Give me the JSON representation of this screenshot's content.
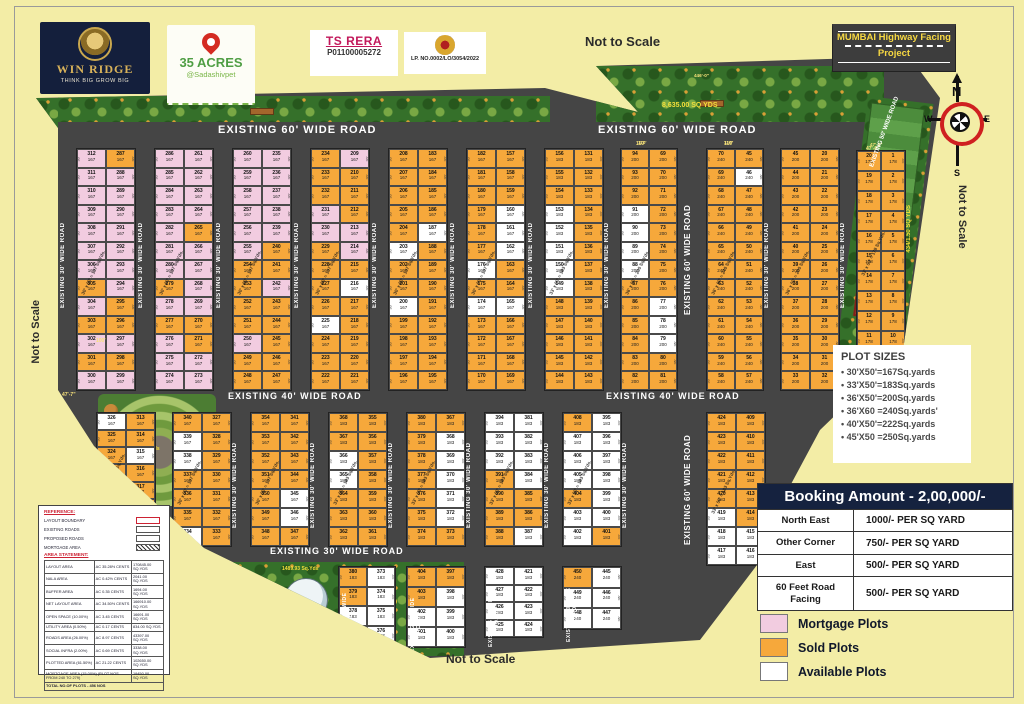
{
  "colors": {
    "bg": "#f3eda6",
    "road": "#454545",
    "mortgage": "#f2cce0",
    "sold": "#f6a83b",
    "available": "#ffffff",
    "navy": "#15223f"
  },
  "logos": {
    "winridge": {
      "title": "WIN RIDGE",
      "tagline": "THINK BIG GROW BIG"
    },
    "acres": {
      "title": "35 ACRES",
      "subtitle": "@Sadashivpet"
    },
    "rera": {
      "title": "TS RERA",
      "number": "P01100005272"
    },
    "dtcp": {
      "lp_no": "LP. NO.0002/LO/3054/2022"
    }
  },
  "mumbai_banner": {
    "line1": "MUMBAI Highway Facing",
    "line2": "Project"
  },
  "scale_notes": {
    "top": "Not to Scale",
    "right": "Not to Scale",
    "left": "Not to Scale",
    "bottom": "Not to Scale"
  },
  "compass": {
    "n": "N",
    "e": "E",
    "s": "S",
    "w": "W"
  },
  "plot_sizes": {
    "title": "PLOT SIZES",
    "items": [
      "30'X50'=167Sq.yards",
      "33'X50'=183Sq.yards",
      "36'X50'=200Sq.yards",
      "36'X60 =240Sq.yards'",
      "40'X50'=222Sq.yards",
      "45'X50 =250Sq.yards"
    ]
  },
  "booking": {
    "title": "Booking Amount - 2,00,000/-",
    "rows": [
      {
        "label": "North East",
        "value": "1000/- PER SQ YARD"
      },
      {
        "label": "Other Corner",
        "value": "750/- PER SQ YARD"
      },
      {
        "label": "East",
        "value": "500/- PER SQ YARD"
      },
      {
        "label": "60 Feet Road Facing",
        "value": "500/- PER SQ YARD"
      }
    ]
  },
  "legend": {
    "items": [
      {
        "label": "Mortgage Plots",
        "color": "#f2cce0"
      },
      {
        "label": "Sold Plots",
        "color": "#f6a83b"
      },
      {
        "label": "Available Plots",
        "color": "#ffffff"
      }
    ]
  },
  "reference": {
    "title": "REFERENCE:",
    "items": [
      "LAYOUT BOUNDARY",
      "EXISTING ROADS",
      "PROPOSED ROADS",
      "MORTGAGE AREA"
    ],
    "area_title": "AREA STATEMENT:",
    "rows": [
      [
        "LAYOUT AREA",
        "AC 35.28½ CENTS",
        "170845.00 SQ.YDS"
      ],
      [
        "NALA AREA",
        "AC 0.42½ CENTS",
        "2041.00 SQ.YDS"
      ],
      [
        "BUFFER AREA",
        "AC 0.35 CENTS",
        "1694.00 SQ.YDS"
      ],
      [
        "NET LAYOUT AREA",
        "AC 34.50½ CENTS",
        "166910.00 SQ.YDS"
      ],
      [
        "OPEN SPACE (10.00%)",
        "AC 3.45 CENTS",
        "16691.00 SQ.YDS"
      ],
      [
        "UTILITY AREA (0.50%)",
        "AC 0.17 CENTS",
        "834.00 SQ.YDS"
      ],
      [
        "ROADS AREA (26.00%)",
        "AC 8.97 CENTS",
        "43397.00 SQ.YDS"
      ],
      [
        "SOCIAL INFRA (2.00%)",
        "AC 0.69 CENTS",
        "3338.00 SQ.YDS"
      ],
      [
        "PLOTTED AREA (61.50%)",
        "AC 21.22 CENTS",
        "102650.00 SQ.YDS"
      ]
    ],
    "mortgage_row": [
      "MORTGAGE AREA (15.00%) (PLOT NOS FROM 240 TO 279)",
      "19450.00 SQ.YDS"
    ],
    "total": "TOTAL NO.OF PLOTS - 456 NOS"
  },
  "road_names": {
    "h60": "EXISTING   60'  WIDE ROAD",
    "h40": "EXISTING  40'  WIDE ROAD",
    "h30": "EXISTING  30'  WIDE ROAD",
    "v30": "EXISTING  30'  WIDE ROAD",
    "v60": "EXISTING  60'  WIDE ROAD",
    "v50": "EXISTING  50'  WIDE ROAD",
    "nala": "EXISTING 6.00 MTR NALA"
  },
  "hroad_labels": [
    {
      "x": 218,
      "y": 124,
      "t": "h60",
      "fs": 11
    },
    {
      "x": 598,
      "y": 124,
      "t": "h60",
      "fs": 11
    },
    {
      "x": 228,
      "y": 391,
      "t": "h40",
      "fs": 9
    },
    {
      "x": 606,
      "y": 391,
      "t": "h40",
      "fs": 9
    },
    {
      "x": 270,
      "y": 546,
      "t": "h30",
      "fs": 9
    }
  ],
  "vroad_labels": [
    {
      "x": 60,
      "y": 200,
      "h": 130,
      "t": "v30",
      "fs": 6
    },
    {
      "x": 138,
      "y": 200,
      "h": 130,
      "t": "v30",
      "fs": 6
    },
    {
      "x": 216,
      "y": 200,
      "h": 130,
      "t": "v30",
      "fs": 6
    },
    {
      "x": 294,
      "y": 200,
      "h": 130,
      "t": "v30",
      "fs": 6
    },
    {
      "x": 372,
      "y": 200,
      "h": 130,
      "t": "v30",
      "fs": 6
    },
    {
      "x": 450,
      "y": 200,
      "h": 130,
      "t": "v30",
      "fs": 6
    },
    {
      "x": 528,
      "y": 200,
      "h": 130,
      "t": "v30",
      "fs": 6
    },
    {
      "x": 604,
      "y": 200,
      "h": 130,
      "t": "v30",
      "fs": 6
    },
    {
      "x": 683,
      "y": 180,
      "h": 160,
      "t": "v60",
      "fs": 8
    },
    {
      "x": 683,
      "y": 420,
      "h": 140,
      "t": "v60",
      "fs": 8
    },
    {
      "x": 764,
      "y": 200,
      "h": 130,
      "t": "v30",
      "fs": 6
    },
    {
      "x": 840,
      "y": 200,
      "h": 130,
      "t": "v30",
      "fs": 6
    },
    {
      "x": 232,
      "y": 430,
      "h": 110,
      "t": "v30",
      "fs": 6
    },
    {
      "x": 310,
      "y": 430,
      "h": 110,
      "t": "v30",
      "fs": 6
    },
    {
      "x": 388,
      "y": 430,
      "h": 110,
      "t": "v30",
      "fs": 6
    },
    {
      "x": 466,
      "y": 430,
      "h": 110,
      "t": "v30",
      "fs": 6
    },
    {
      "x": 544,
      "y": 430,
      "h": 110,
      "t": "v30",
      "fs": 6
    },
    {
      "x": 622,
      "y": 430,
      "h": 110,
      "t": "v30",
      "fs": 6
    },
    {
      "x": 342,
      "y": 585,
      "h": 70,
      "t": "v30",
      "fs": 5
    },
    {
      "x": 410,
      "y": 590,
      "h": 70,
      "t": "v30",
      "fs": 5
    },
    {
      "x": 488,
      "y": 585,
      "h": 70,
      "t": "v30",
      "fs": 5
    },
    {
      "x": 566,
      "y": 580,
      "h": 70,
      "t": "v30",
      "fs": 5
    }
  ],
  "green_labels": {
    "top_garden": "8,635.00 SQ YDS",
    "right_park": "434/1.50 SQ YDS",
    "tank_park": "1489.93 Sq.Yds",
    "amphi_park": "969.00 Sq.Yds"
  },
  "dim_labels": [
    {
      "x": 636,
      "y": 141,
      "t": "110'"
    },
    {
      "x": 724,
      "y": 141,
      "t": "110'"
    },
    {
      "x": 62,
      "y": 392,
      "t": "47'-7\""
    },
    {
      "x": 96,
      "y": 338,
      "t": "100'"
    },
    {
      "x": 694,
      "y": 73,
      "t": "446'-0\""
    },
    {
      "x": 866,
      "y": 146,
      "t": "47'-6\""
    }
  ],
  "blocks": [
    {
      "x": 76,
      "y": 148,
      "w": 58,
      "h": 241,
      "rows": 13,
      "start": 287,
      "area": "167",
      "dim": "30'",
      "diag": "30' x 50' = 167 Sq.Yds.",
      "colors": [
        "po",
        "pp",
        "pp",
        "pp",
        "pp",
        "pp",
        "pp",
        "op",
        "po",
        "oo",
        "pp",
        "oo",
        "pp"
      ]
    },
    {
      "x": 154,
      "y": 148,
      "w": 58,
      "h": 241,
      "rows": 13,
      "start": 261,
      "area": "167",
      "dim": "30'",
      "diag": "30' x 50' = 167 Sq.Yds.",
      "colors": [
        "pp",
        "pp",
        "pp",
        "pp",
        "po",
        "pp",
        "pp",
        "op",
        "pp",
        "oo",
        "po",
        "pp",
        "pp"
      ]
    },
    {
      "x": 232,
      "y": 148,
      "w": 58,
      "h": 241,
      "rows": 13,
      "start": 235,
      "area": "167",
      "dim": "30'",
      "diag": "30' x 50' = 167 Sq.Yds.",
      "colors": [
        "pp",
        "pp",
        "pp",
        "pp",
        "pp",
        "po",
        "oo",
        "op",
        "oo",
        "oo",
        "po",
        "oo",
        "oo"
      ]
    },
    {
      "x": 310,
      "y": 148,
      "w": 58,
      "h": 241,
      "rows": 13,
      "start": 209,
      "area": "167",
      "dim": "30'",
      "diag": "30' x 50' = 167 Sq.Yds.",
      "colors": [
        "op",
        "oo",
        "oo",
        "po",
        "pp",
        "op",
        "oo",
        "ow",
        "oo",
        "wo",
        "oo",
        "oo",
        "oo"
      ]
    },
    {
      "x": 388,
      "y": 148,
      "w": 58,
      "h": 241,
      "rows": 13,
      "start": 183,
      "area": "167",
      "dim": "30'",
      "diag": "30' x 50' = 167 Sq.Yds.",
      "colors": [
        "oo",
        "oo",
        "oo",
        "oo",
        "ow",
        "wo",
        "oo",
        "oo",
        "wo",
        "oo",
        "oo",
        "oo",
        "oo"
      ]
    },
    {
      "x": 466,
      "y": 148,
      "w": 58,
      "h": 241,
      "rows": 13,
      "start": 157,
      "area": "167",
      "dim": "30'",
      "diag": "30' x 50' = 167 Sq.Yds.",
      "colors": [
        "oo",
        "oo",
        "oo",
        "ow",
        "ow",
        "ow",
        "wo",
        "oo",
        "ww",
        "oo",
        "oo",
        "oo",
        "oo"
      ]
    },
    {
      "x": 544,
      "y": 148,
      "w": 58,
      "h": 241,
      "rows": 13,
      "start": 131,
      "area": "183",
      "dim": "33'",
      "diag": "33' x 50' = 183 Sq.Yds.",
      "colors": [
        "oo",
        "oo",
        "oo",
        "wo",
        "wo",
        "wo",
        "wo",
        "wo",
        "oo",
        "oo",
        "oo",
        "oo",
        "oo"
      ]
    },
    {
      "x": 620,
      "y": 148,
      "w": 56,
      "h": 241,
      "rows": 13,
      "start": 69,
      "area": "200",
      "dim": "36'",
      "diag": "36' x 50' = 200 Sq.Yds.",
      "topdim": "110'",
      "colors": [
        "oo",
        "oo",
        "oo",
        "wo",
        "wo",
        "wo",
        "wo",
        "oo",
        "ow",
        "ow",
        "ow",
        "oo",
        "oo"
      ]
    },
    {
      "x": 706,
      "y": 148,
      "w": 56,
      "h": 241,
      "rows": 13,
      "start": 45,
      "area": "240",
      "dim": "36'",
      "diag": "36' x 60' = 240 Sq.Yds.",
      "topdim": "110'",
      "colors": [
        "oo",
        "ow",
        "oo",
        "oo",
        "oo",
        "oo",
        "oo",
        "oo",
        "oo",
        "oo",
        "oo",
        "oo",
        "oo"
      ]
    },
    {
      "x": 780,
      "y": 148,
      "w": 58,
      "h": 241,
      "rows": 13,
      "start": 20,
      "area": "200",
      "dim": "36'",
      "diag": "36' x 50' = 200 Sq.Yds.",
      "colors": [
        "oo",
        "oo",
        "oo",
        "oo",
        "oo",
        "oo",
        "oo",
        "oo",
        "oo",
        "oo",
        "oo",
        "oo",
        "oo"
      ]
    },
    {
      "x": 856,
      "y": 150,
      "w": 48,
      "h": 200,
      "rows": 10,
      "start": 1,
      "area": "178",
      "dim": "33'",
      "diag": "33' x 50' = 178 Sq.Yds.",
      "topdim": "47'-6\"",
      "colors": [
        "oo",
        "oo",
        "oo",
        "oo",
        "oo",
        "oo",
        "oo",
        "oo",
        "oo",
        "oo"
      ]
    },
    {
      "x": 96,
      "y": 412,
      "w": 58,
      "h": 120,
      "rows": 7,
      "start": 313,
      "area": "167",
      "dim": "30'",
      "diag": "30' x 50' = 167 Sq.Yds.",
      "colors": [
        "wo",
        "oo",
        "ow",
        "oo",
        "wo",
        "oo",
        "wo"
      ]
    },
    {
      "x": 172,
      "y": 412,
      "w": 58,
      "h": 133,
      "rows": 7,
      "start": 327,
      "area": "167",
      "dim": "30'",
      "diag": "30' x 50' = 167 Sq.Yds.",
      "colors": [
        "oo",
        "wo",
        "wo",
        "oo",
        "oo",
        "oo",
        "wo"
      ]
    },
    {
      "x": 250,
      "y": 412,
      "w": 58,
      "h": 133,
      "rows": 7,
      "start": 341,
      "area": "167",
      "dim": "30'",
      "diag": "30' x 50' = 167 Sq.Yds.",
      "colors": [
        "oo",
        "oo",
        "oo",
        "oo",
        "ow",
        "ow",
        "oo"
      ]
    },
    {
      "x": 328,
      "y": 412,
      "w": 58,
      "h": 133,
      "rows": 7,
      "start": 355,
      "area": "183",
      "dim": "33'",
      "diag": "33' x 50' = 183 Sq.Yds.",
      "colors": [
        "oo",
        "oo",
        "wo",
        "wo",
        "oo",
        "oo",
        "oo"
      ]
    },
    {
      "x": 406,
      "y": 412,
      "w": 58,
      "h": 133,
      "rows": 7,
      "start": 367,
      "area": "183",
      "dim": "33'",
      "diag": "33' x 50' = 183 Sq.Yds.",
      "colors": [
        "oo",
        "ow",
        "ow",
        "ow",
        "ow",
        "ow",
        "oo"
      ]
    },
    {
      "x": 484,
      "y": 412,
      "w": 58,
      "h": 133,
      "rows": 7,
      "start": 381,
      "area": "183",
      "dim": "33'",
      "diag": "33' x 50' = 183 Sq.Yds.",
      "colors": [
        "ww",
        "ww",
        "ww",
        "ow",
        "oo",
        "oo",
        "ow"
      ]
    },
    {
      "x": 562,
      "y": 412,
      "w": 58,
      "h": 133,
      "rows": 7,
      "start": 395,
      "area": "183",
      "dim": "33'",
      "diag": "33' x 50' = 183 Sq.Yds.",
      "colors": [
        "ow",
        "ww",
        "ww",
        "ww",
        "ow",
        "ww",
        "wo"
      ]
    },
    {
      "x": 706,
      "y": 412,
      "w": 58,
      "h": 152,
      "rows": 8,
      "start": 409,
      "area": "183",
      "dim": "33'",
      "diag": "33' x 50' = 183 Sq.Yds.",
      "colors": [
        "oo",
        "oo",
        "oo",
        "oo",
        "oo",
        "wo",
        "ww",
        "ww"
      ]
    },
    {
      "x": 338,
      "y": 566,
      "w": 56,
      "h": 78,
      "rows": 4,
      "start": 373,
      "area": "183",
      "dim": "33'",
      "colors": [
        "ow",
        "ow",
        "ww",
        "ww"
      ]
    },
    {
      "x": 406,
      "y": 566,
      "w": 58,
      "h": 80,
      "rows": 4,
      "start": 397,
      "area": "183",
      "dim": "33'",
      "colors": [
        "oo",
        "ow",
        "ww",
        "ww"
      ]
    },
    {
      "x": 484,
      "y": 566,
      "w": 58,
      "h": 70,
      "rows": 4,
      "start": 421,
      "area": "183",
      "dim": "33'",
      "colors": [
        "ww",
        "ww",
        "ww",
        "ww"
      ]
    },
    {
      "x": 562,
      "y": 566,
      "w": 58,
      "h": 62,
      "rows": 3,
      "start": 445,
      "area": "240",
      "dim": "36'",
      "colors": [
        "ow",
        "ww",
        "ww"
      ]
    }
  ]
}
